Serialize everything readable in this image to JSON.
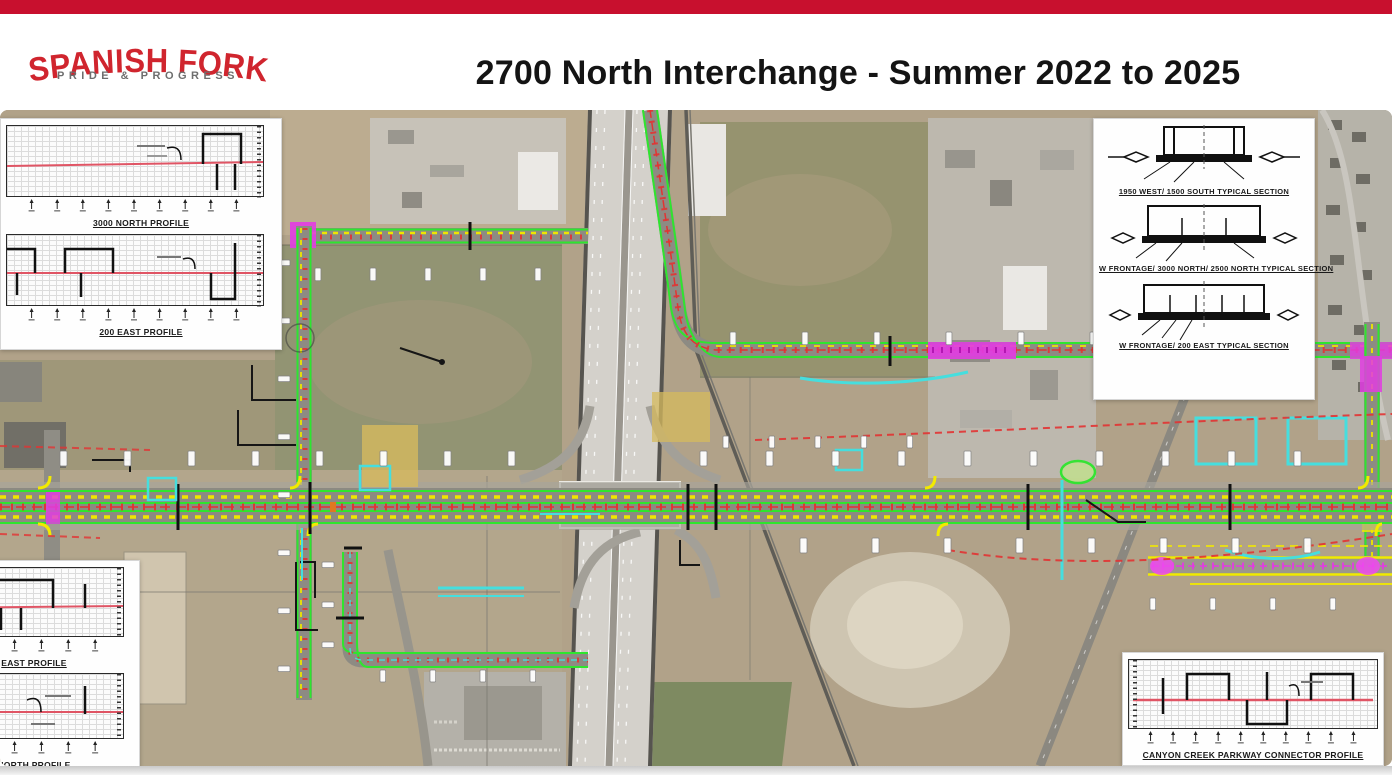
{
  "page": {
    "topbar_color": "#C8102E"
  },
  "header": {
    "logo": {
      "line1": "SPANISH FORK",
      "line2": "PRIDE & PROGRESS",
      "color_primary": "#D0252E",
      "color_secondary": "#6e6e6e"
    },
    "title": "2700 North Interchange - Summer 2022 to 2025"
  },
  "map": {
    "description": "Aerial construction plan of the 2700 North / I-15 interchange with proposed roadway striping overlays",
    "legend_colors": {
      "proposed_edge_line": "#2ee62e",
      "lane_marking": "#eee600",
      "centerline_ties": "#e23333",
      "future_phase": "#e23ce2",
      "utility_relocation": "#45dede",
      "work_zone": "#d6b95e"
    },
    "insets": {
      "top_left": {
        "charts": [
          {
            "title": "3000 NORTH PROFILE"
          },
          {
            "title": "200 EAST PROFILE"
          }
        ]
      },
      "top_right": {
        "sections": [
          {
            "title": "1950 WEST/ 1500 SOUTH TYPICAL SECTION"
          },
          {
            "title": "W FRONTAGE/ 3000 NORTH/ 2500 NORTH TYPICAL SECTION"
          },
          {
            "title": "W FRONTAGE/ 200 EAST TYPICAL SECTION"
          }
        ]
      },
      "bottom_left": {
        "charts": [
          {
            "title": "EAST PROFILE"
          },
          {
            "title": "NORTH PROFILE"
          }
        ]
      },
      "bottom_right": {
        "charts": [
          {
            "title": "CANYON CREEK PARKWAY CONNECTOR PROFILE"
          }
        ]
      }
    }
  }
}
